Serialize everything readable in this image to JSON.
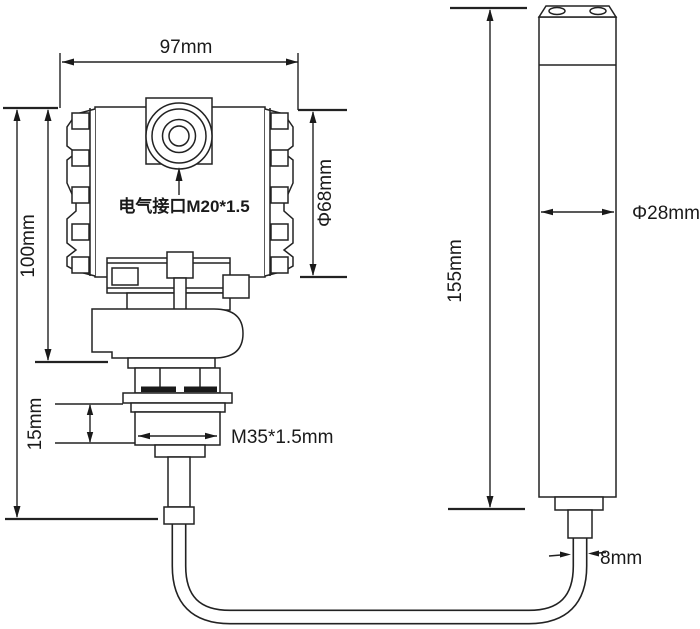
{
  "diagram": {
    "type": "technical-dimension-drawing",
    "subject": "pressure/level transmitter with submersible probe and connecting cable",
    "background": "#ffffff",
    "line_color": "#222222",
    "labels": {
      "head_width": "97mm",
      "head_height": "100mm",
      "head_diameter": "Φ68mm",
      "electrical_interface": "电气接口M20*1.5",
      "thread_length": "15mm",
      "thread_spec": "M35*1.5mm",
      "probe_length": "155mm",
      "probe_diameter": "Φ28mm",
      "cable_diameter": "8mm"
    }
  }
}
